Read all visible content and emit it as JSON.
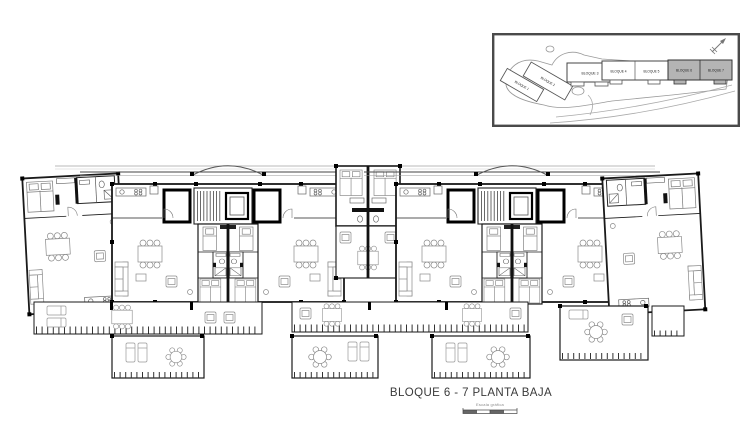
{
  "window": {
    "background": "#ffffff"
  },
  "drawing": {
    "title": "BLOQUE 6 - 7 PLANTA BAJA",
    "scale_label": "Escala gráfica",
    "ink_color": "#1f1f1f",
    "furniture_color": "#8a8a8a"
  },
  "site_inset": {
    "highlight_color": "#b4b4b4",
    "road_color": "#9a9a9a",
    "north_arrow_icon": "north-arrow",
    "blocks": [
      {
        "label": "BLOQUE 1",
        "highlighted": false
      },
      {
        "label": "BLOQUE 2",
        "highlighted": false
      },
      {
        "label": "BLOQUE 3",
        "highlighted": false
      },
      {
        "label": "BLOQUE 4",
        "highlighted": false
      },
      {
        "label": "BLOQUE 5",
        "highlighted": false
      },
      {
        "label": "BLOQUE 6",
        "highlighted": true
      },
      {
        "label": "BLOQUE 7",
        "highlighted": true
      }
    ]
  }
}
